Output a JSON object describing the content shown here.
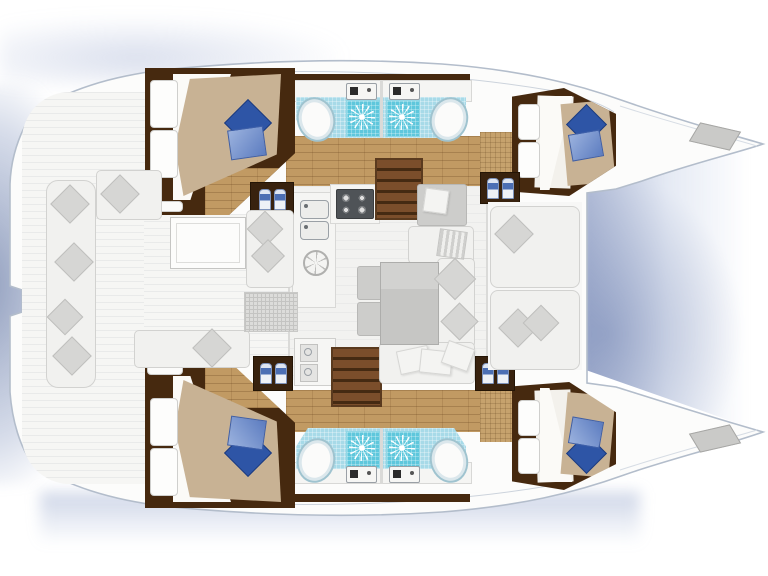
{
  "diagram": {
    "type": "catamaran-floor-plan",
    "view": "top-down deck plan",
    "orientation": {
      "bow": "right",
      "stern": "left"
    },
    "hulls": {
      "port": {
        "aft_cabin": {
          "label": "Port aft cabin",
          "bed": "double berth",
          "white_pillows": 2,
          "accent_pillows": [
            "dark blue",
            "light blue"
          ],
          "wardrobe_panels": 2
        },
        "aft_head": {
          "label": "Port aft head",
          "fixtures": [
            "toilet",
            "washbasin",
            "shower"
          ]
        },
        "fwd_head": {
          "label": "Port forward head",
          "fixtures": [
            "toilet",
            "washbasin",
            "shower"
          ]
        },
        "fwd_cabin": {
          "label": "Port forward cabin",
          "bed": "double berth",
          "white_pillows": 2,
          "accent_pillows": [
            "dark blue",
            "light blue"
          ],
          "wardrobe_panels": 2
        },
        "bow_hatch": "deck hatch"
      },
      "starboard": {
        "aft_cabin": {
          "label": "Starboard aft cabin",
          "bed": "double berth",
          "white_pillows": 2,
          "accent_pillows": [
            "dark blue",
            "light blue"
          ],
          "wardrobe_panels": 2
        },
        "aft_head": {
          "label": "Starboard aft head",
          "fixtures": [
            "toilet",
            "washbasin",
            "shower"
          ]
        },
        "fwd_head": {
          "label": "Starboard forward head",
          "fixtures": [
            "toilet",
            "washbasin",
            "shower"
          ]
        },
        "fwd_cabin": {
          "label": "Starboard forward cabin",
          "bed": "double berth",
          "white_pillows": 2,
          "accent_pillows": [
            "dark blue",
            "light blue"
          ],
          "wardrobe_panels": 2
        },
        "bow_hatch": "deck hatch"
      }
    },
    "salon": {
      "label": "Salon and galley",
      "galley": {
        "sinks": 2,
        "stove_burners": 4,
        "round_hatch": 1,
        "refrigerator_doors": 2
      },
      "dining": {
        "table": "rectangular dining table",
        "sofa": "U-shaped settee",
        "stools": 2
      },
      "chart_table": "chart table with cushion",
      "companionway_stairs": 2,
      "bottle_lockers": 4,
      "bottles_per_locker": 2
    },
    "cockpit": {
      "label": "Aft cockpit",
      "table": "cockpit table",
      "benches": [
        "transom side bench",
        "corner bench",
        "aft bench",
        "bench beside table"
      ],
      "grating": "deck grating",
      "cushions": "gray diamond cushions"
    },
    "foredeck": {
      "label": "Forward cockpit",
      "benches": 2,
      "cushions": 3
    },
    "totals": {
      "cabins": 4,
      "heads": 4,
      "showers": 4,
      "toilets": 4,
      "washbasins": 4
    },
    "colors": {
      "water_shadow": "#8296bd",
      "hull_outline": "#b3bdcb",
      "deck": "#f6f6f4",
      "wood_floor": "#c19a63",
      "dark_wood": "#46290f",
      "stair_tread": "#7b4e2b",
      "bed_duvet": "#c8b294",
      "pillow_blue_dark": "#2e55a6",
      "pillow_blue_light": "#86a0d4",
      "head_tile": "#a7dae8",
      "shower_tile": "#5ec7dc",
      "upholstery": "#f1f1ef",
      "table_top": "#cbcbc9"
    }
  }
}
